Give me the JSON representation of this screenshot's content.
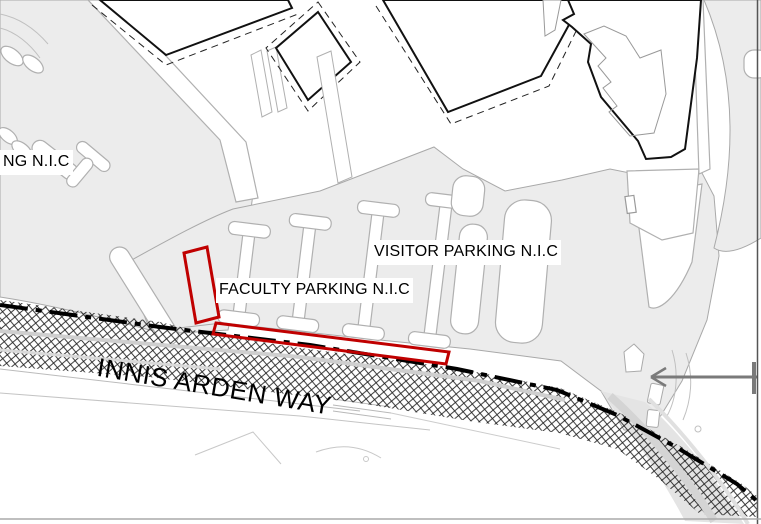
{
  "map": {
    "street": {
      "name": "INNIS ARDEN WAY"
    },
    "labels": {
      "left_parking": "NG N.I.C",
      "visitor_parking": "VISITOR PARKING N.I.C",
      "faculty_parking": "FACULTY PARKING N.I.C"
    },
    "highlight": {
      "color": "#c00000",
      "areas": [
        "faculty-parking-stall-bay",
        "faculty-parking-roadside-strip"
      ]
    },
    "leader_arrow": {
      "direction": "left",
      "color": "#7a7a7a"
    },
    "styles": {
      "road_reserve_fill": "crosshatch",
      "road_centerline": "dash-dot",
      "pavement_color": "#ececec"
    }
  }
}
